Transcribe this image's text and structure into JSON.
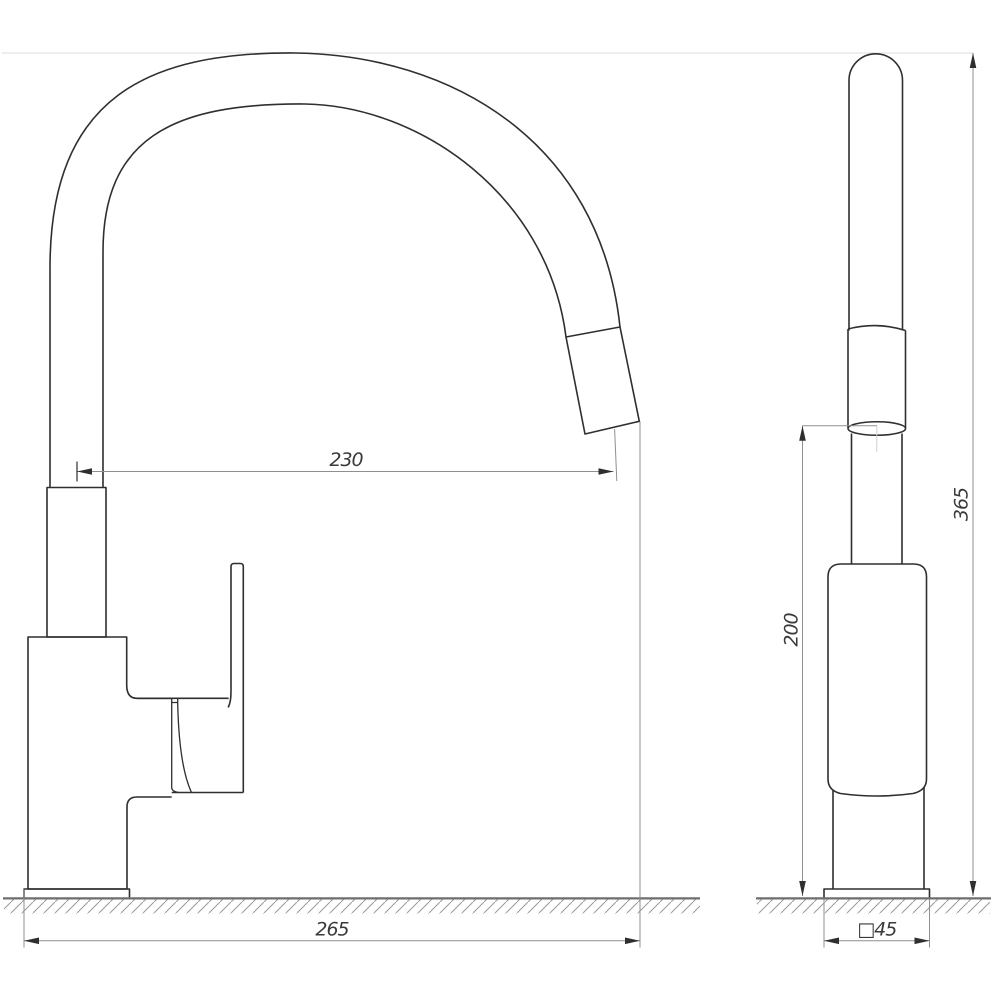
{
  "drawing": {
    "type": "faucet-dimension-drawing",
    "views": {
      "side_view": "side-view",
      "front_view": "front-view"
    },
    "dimensions": {
      "spout_reach": "230",
      "overall_length": "265",
      "outlet_height": "200",
      "overall_height": "365",
      "base_width": "□45"
    },
    "colors": {
      "background": "#ffffff",
      "object_line": "#2f2f2f",
      "dimension_line": "#8f8f8f",
      "extension_line_light": "#e4e4e4",
      "ground_line": "#6e6e6e",
      "hatch_line": "#9a9a9a",
      "label_text": "#3a3a3a"
    }
  }
}
